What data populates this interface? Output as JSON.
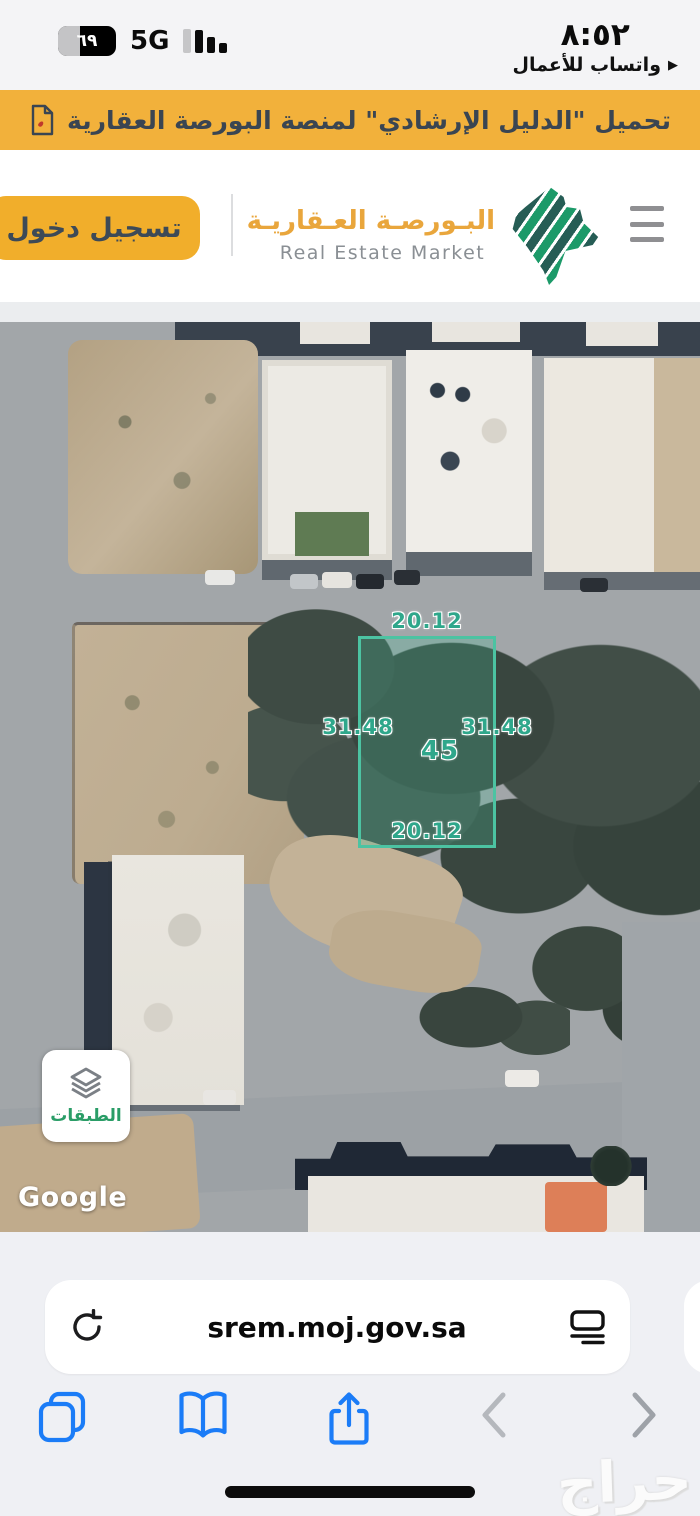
{
  "status_bar": {
    "time": "٨:٥٢",
    "app_return": "واتساب للأعمال",
    "battery_percent": "٦٩",
    "network": "5G"
  },
  "banner": {
    "text": "تحميل \"الدليل الإرشادي\" لمنصة البورصة العقارية"
  },
  "header": {
    "login_label": "تسجيل دخول",
    "brand_ar": "البـورصـة العـقاريـة",
    "brand_en": "Real Estate Market"
  },
  "map": {
    "parcel": {
      "top": "20.12",
      "bottom": "20.12",
      "left": "31.48",
      "right": "31.48",
      "number": "45"
    },
    "layers_label": "الطبقات",
    "google_label": "Google"
  },
  "browser": {
    "url": "srem.moj.gov.sa"
  },
  "watermark": "حراج",
  "colors": {
    "banner_yellow": "#F2B13B",
    "button_yellow": "#F1AE2B",
    "brand_orange": "#E9A63C",
    "logo_green": "#1C9A69",
    "logo_teal": "#265D55",
    "parcel_teal": "#4CC3A2",
    "parcel_label": "#2FA78B",
    "layers_green": "#2A9D67",
    "safari_blue": "#1B7CF7",
    "chrome_gray": "#EFF0F4"
  }
}
